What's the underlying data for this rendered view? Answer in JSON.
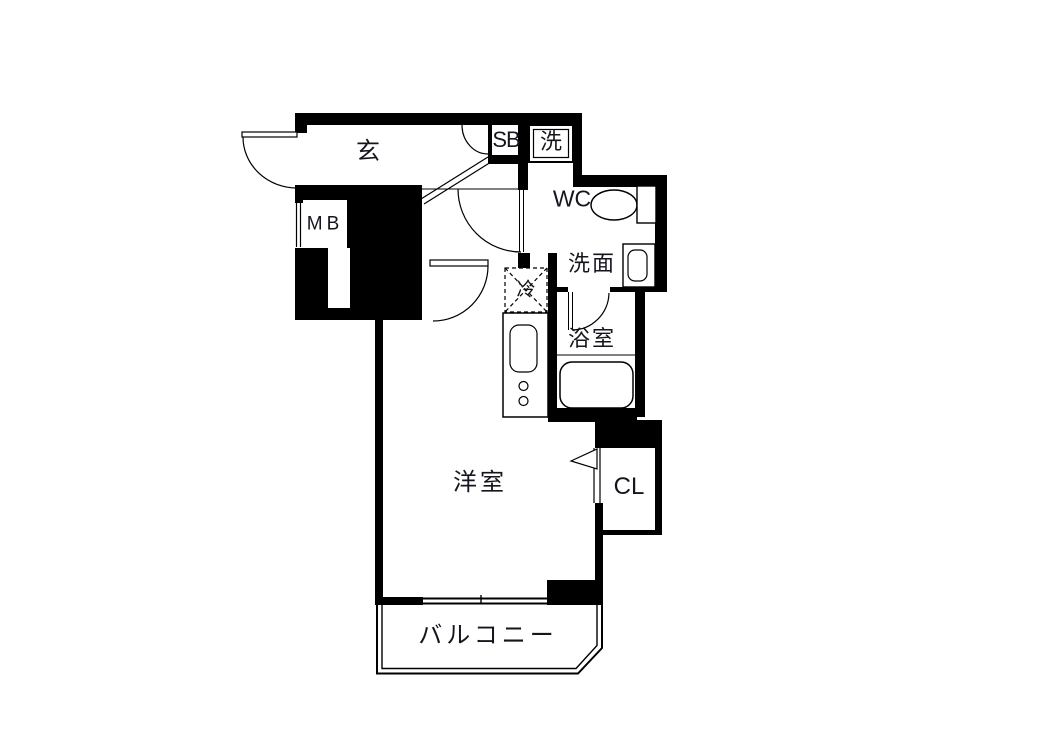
{
  "page": {
    "background": "#ffffff"
  },
  "floor_plan": {
    "wall_color": "#000000",
    "line_color": "#000000",
    "text_color": "#15151d",
    "rooms": {
      "genkan": {
        "label": "玄"
      },
      "shoe_box": {
        "label": "SB"
      },
      "washing_machine": {
        "label": "洗"
      },
      "toilet": {
        "label": "WC"
      },
      "washroom": {
        "label": "洗面"
      },
      "meter_box": {
        "label": "MB"
      },
      "refrigerator": {
        "label": "冷"
      },
      "bathroom": {
        "label": "浴室"
      },
      "western_room": {
        "label": "洋室"
      },
      "closet": {
        "label": "CL"
      },
      "balcony": {
        "label": "バルコニー"
      }
    },
    "fixture_icons": [
      "entrance-door-icon",
      "shoebox-door-icon",
      "washroom-door-icon",
      "western-room-door-icon",
      "bathroom-door-icon",
      "closet-folding-door-icon",
      "meter-box-door-icon",
      "toilet-bowl-icon",
      "wash-basin-icon",
      "washing-machine-pan-icon",
      "refrigerator-space-icon",
      "kitchen-sink-icon",
      "gas-burner-icon",
      "bathtub-icon",
      "sliding-window-icon",
      "balcony-railing-icon",
      "entrance-step-icon"
    ]
  }
}
